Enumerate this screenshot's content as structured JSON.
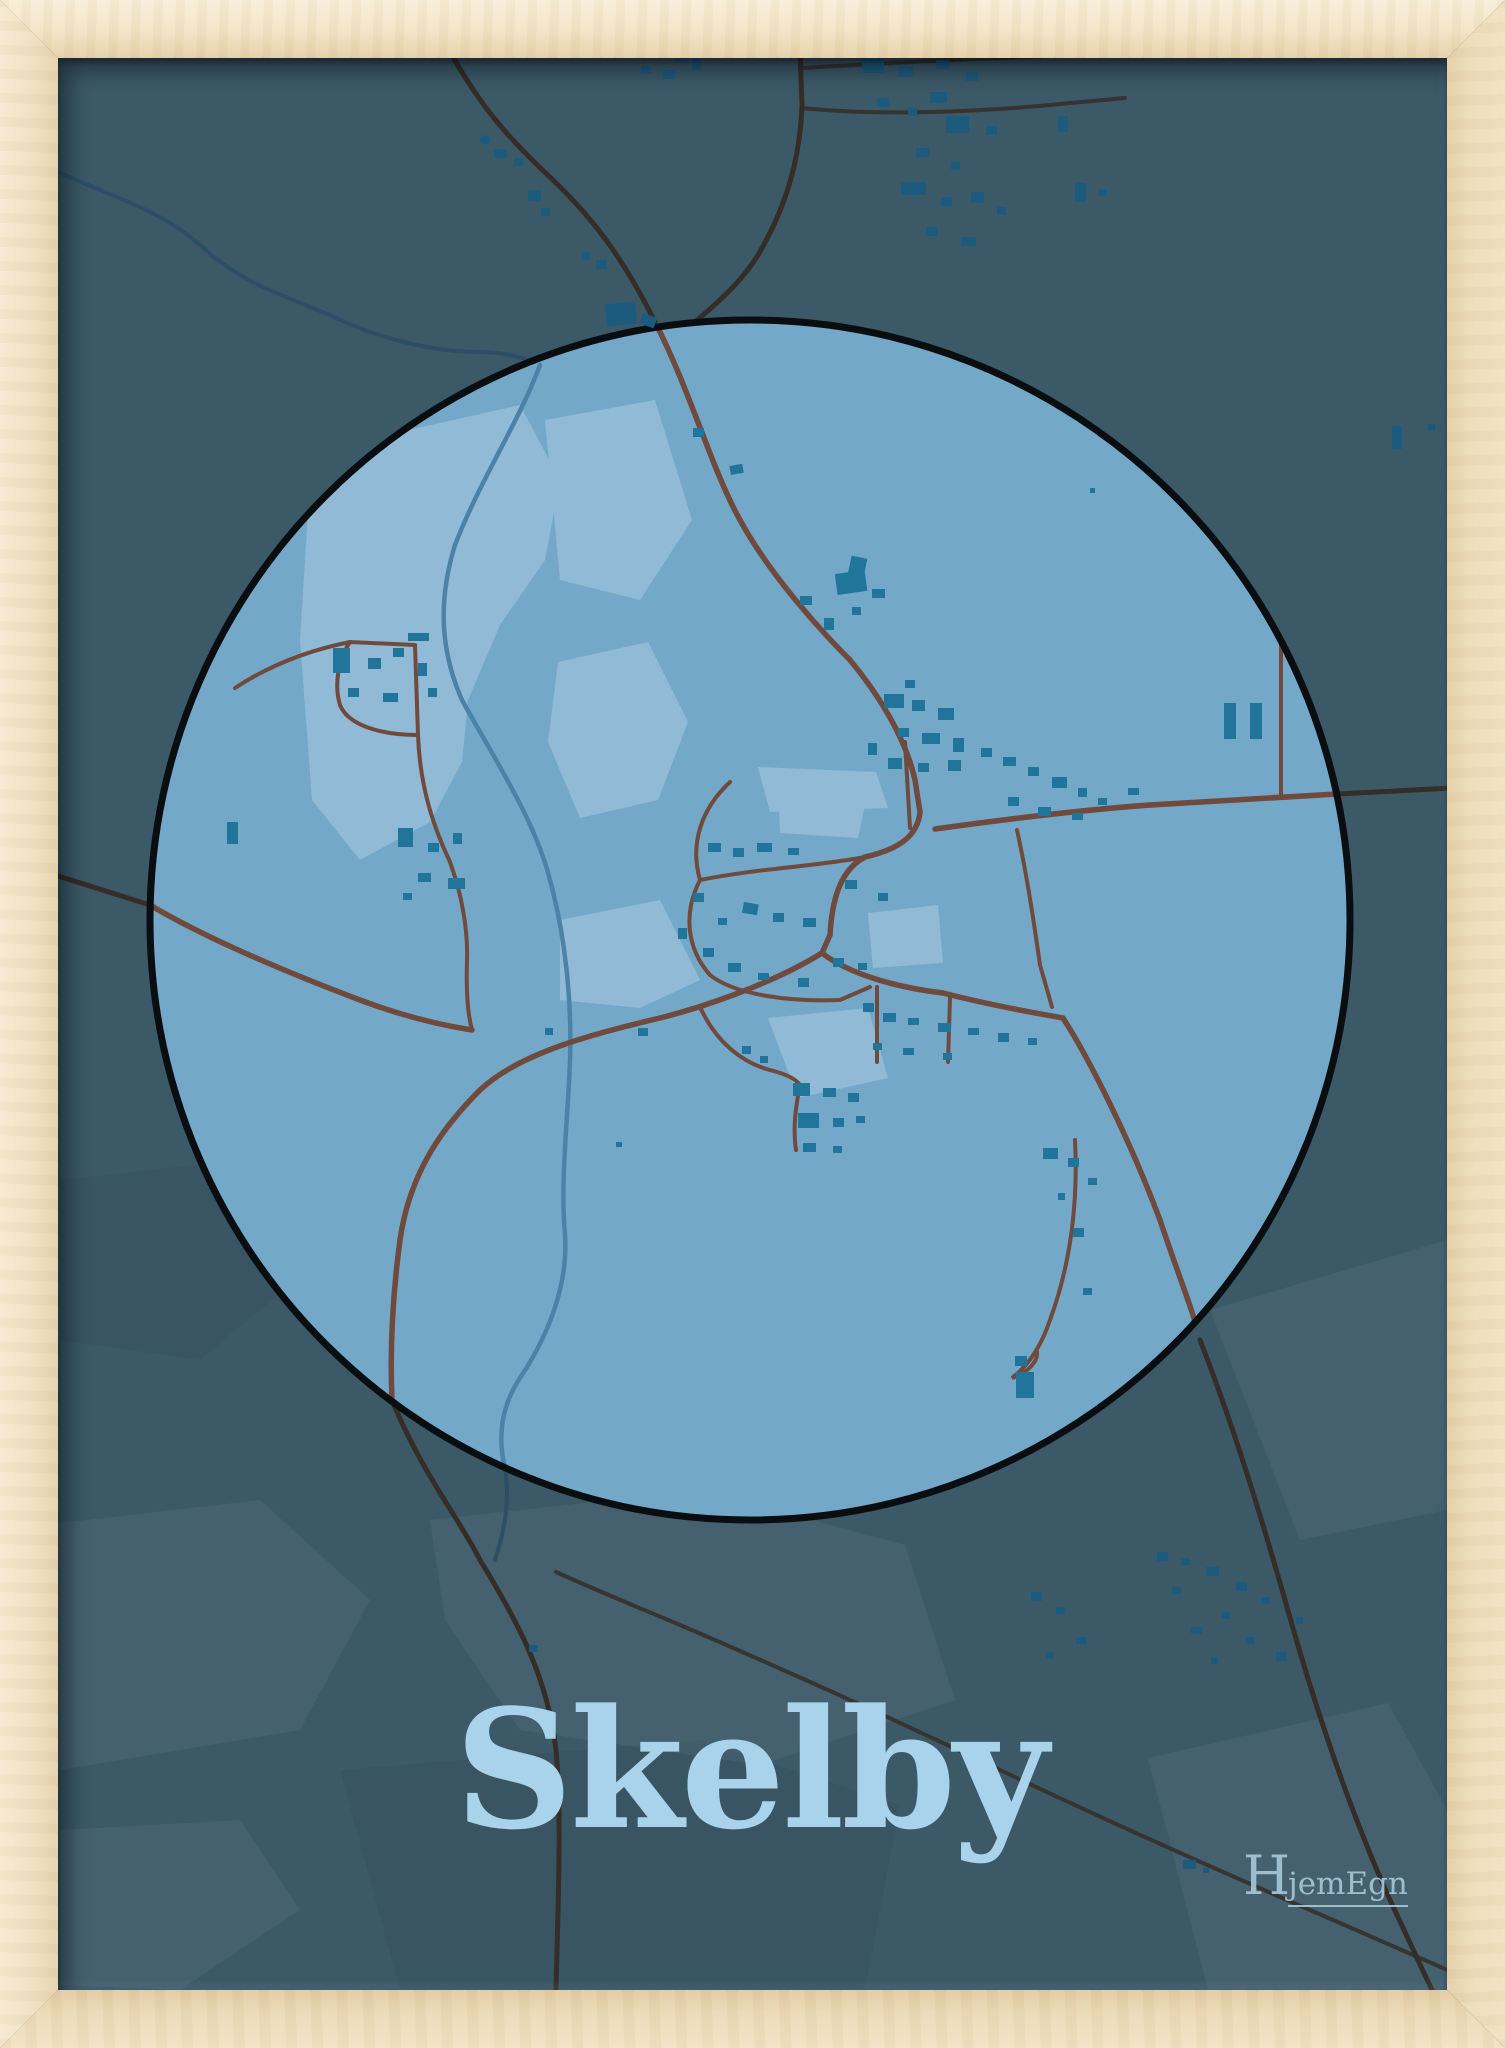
{
  "poster": {
    "title": "Skelby",
    "brand_initial": "H",
    "brand_rest": "jemEgn",
    "place_name": "Skelby",
    "type": "framed map poster",
    "map_shape": "circle"
  },
  "colors": {
    "frame_wood": "#f3e6cb",
    "poster_bg": "#3c5968",
    "map_circle_fill": "#74a8c8",
    "map_circle_stroke": "#0b0e11",
    "map_patch_light": "#90bad5",
    "map_road_town": "#6f4a3d",
    "map_road_rural": "#352d27",
    "map_river_town": "#4d82a8",
    "map_river_rural": "#2e4e66",
    "map_building_town": "#21749a",
    "map_building_rural": "#1d5b7e",
    "title_color": "#a9d3ea",
    "brand_color": "#a6c6d8"
  }
}
